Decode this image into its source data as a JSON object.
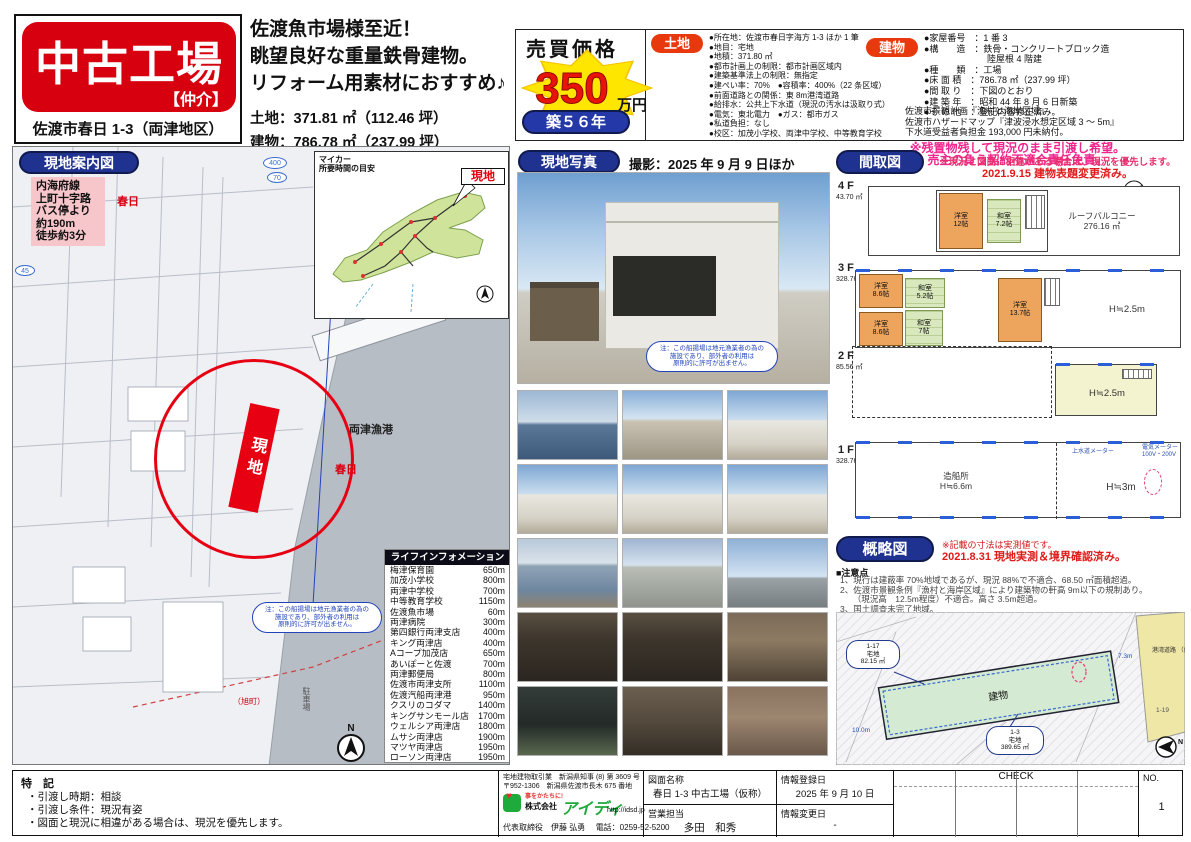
{
  "header": {
    "title": "中古工場",
    "broker": "【仲介】",
    "address": "佐渡市春日 1-3（両津地区）",
    "catch1": "佐渡魚市場様至近！",
    "catch2": "眺望良好な重量鉄骨建物。",
    "catch3": "リフォーム用素材におすすめ♪",
    "land_line": "土地：371.81 ㎡（112.46 坪）",
    "building_line": "建物：786.78 ㎡（237.99 坪）",
    "price_label": "売買価格",
    "price_value": "350",
    "price_unit": "万円",
    "age_badge": "築５６年"
  },
  "land": {
    "label": "土地",
    "items": [
      "●所在地：佐渡市春日字海方 1-3 ほか 1 筆",
      "●地目：宅地",
      "●地積：371.80 ㎡",
      "●都市計画上の制限：都市計画区域内",
      "●建築基準法上の制限：無指定",
      "●建ぺい率：70%　●容積率：400%（22 条区域）",
      "●前面道路との関係：東 8m港湾道路",
      "●給排水：公共上下水道（現況の汚水は汲取り式）",
      "●電気：東北電力　●ガス：都市ガス",
      "●私道負担：なし",
      "●校区：加茂小学校、両津中学校、中等教育学校"
    ]
  },
  "building": {
    "label": "建物",
    "items": [
      "●家屋番号　：1 番 3",
      "●構　　造　：鉄骨・コンクリートブロック造\n　　　　　　　陸屋根 4 階建",
      "●種　　類　：工場",
      "●床 面 積　：786.78 ㎡（237.99 坪）",
      "●間 取 り　：下図のとおり",
      "●建 築 年　：昭和 44 年 8 月 6 日新築",
      "●そ の 他　：登記内容修正済み。"
    ],
    "extra": [
      "佐渡市景観計画『漁村と海岸区域』",
      "佐渡市ハザードマップ『津波浸水想定区域 3 ～ 5m』",
      "下水道受益者負担金 193,000 円未納付。"
    ],
    "warn1": "※残置物残して現況のまま引渡し希望。",
    "warn2": "売主の負う契約不適合責任免責。"
  },
  "map": {
    "header": "現地案内図",
    "bus_note": "内海府線\n上町十字路\nバス停より\n約190m\n徒歩約3分",
    "inset_title": "マイカー\n所要時間の目安",
    "inset_site": "現地",
    "route_400": "400",
    "route_70": "70",
    "route_45": "45",
    "kasuga": "春日",
    "port": "両津漁港",
    "asahi": "（旭町）",
    "parking": "駐車場",
    "site": "現地",
    "boat_note": "注：この船揚場は地元漁業者の為の\n施設であり、部外者の利用は\n原則的に許可が出ません。",
    "compass": "N",
    "lifeline_title": "ライフインフォメーション",
    "lifeline": [
      [
        "梅津保育園",
        "650m"
      ],
      [
        "加茂小学校",
        "800m"
      ],
      [
        "両津中学校",
        "700m"
      ],
      [
        "中等教育学校",
        "1150m"
      ],
      [
        "佐渡魚市場",
        "60m"
      ],
      [
        "両津病院",
        "300m"
      ],
      [
        "第四銀行両津支店",
        "400m"
      ],
      [
        "キング両津店",
        "400m"
      ],
      [
        "Aコープ加茂店",
        "650m"
      ],
      [
        "あいぽーと佐渡",
        "700m"
      ],
      [
        "両津郵便局",
        "800m"
      ],
      [
        "佐渡市両津支所",
        "1100m"
      ],
      [
        "佐渡汽船両津港",
        "950m"
      ],
      [
        "クスリのコダマ",
        "1400m"
      ],
      [
        "キングサンモール店",
        "1700m"
      ],
      [
        "ウェルシア両津店",
        "1800m"
      ],
      [
        "ムサシ両津店",
        "1900m"
      ],
      [
        "マツヤ両津店",
        "1950m"
      ],
      [
        "ローソン両津店",
        "1950m"
      ]
    ]
  },
  "photos": {
    "header": "現地写真",
    "shot": "撮影：2025 年 9 月 9 日ほか",
    "note": "注：この船揚場は地元漁業者の為の\n施設であり、部外者の利用は\n原則的に許可が出ません。",
    "items": [
      {
        "kind": "harbor"
      },
      {
        "kind": "slipway"
      },
      {
        "kind": "exterior"
      },
      {
        "kind": "exterior"
      },
      {
        "kind": "exterior"
      },
      {
        "kind": "exterior"
      },
      {
        "kind": "aerial"
      },
      {
        "kind": "town"
      },
      {
        "kind": "rooftop"
      },
      {
        "kind": "workshop"
      },
      {
        "kind": "workshop"
      },
      {
        "kind": "interior"
      },
      {
        "kind": "bathroom"
      },
      {
        "kind": "corridor"
      },
      {
        "kind": "living"
      }
    ]
  },
  "madori": {
    "header": "間取図",
    "note1": "※現況と図面に相違がある場合は、現況を優先します。",
    "note2": "2021.9.15 建物表題変更済み。",
    "compass": "N",
    "floor4": {
      "name": "4 F",
      "area": "43.70 ㎡",
      "room1": "洋室\n12帖",
      "room2": "和室\n7.2帖",
      "balcony": "ルーフバルコニー\n276.16 ㎡"
    },
    "floor3": {
      "name": "3 F",
      "area": "328.76 ㎡",
      "room1": "洋室\n8.6帖",
      "room2": "和室\n5.2帖",
      "room3": "洋室\n8.6帖",
      "room4": "和室\n7帖",
      "room5": "洋室\n13.7帖",
      "height": "H≒2.5m"
    },
    "floor2": {
      "name": "2 F",
      "area": "85.56 ㎡",
      "height": "H≒2.5m"
    },
    "floor1": {
      "name": "1 F",
      "area": "328.76 ㎡",
      "label": "造船所\nH≒6.6m",
      "height": "H≒3m",
      "meter1": "上水道メーター",
      "meter2": "電気メーター\n100V・200V"
    }
  },
  "sketch": {
    "header": "概略図",
    "note1": "※記載の寸法は実測値です。",
    "note2": "2021.8.31 現地実測＆境界確認済み。",
    "caution_title": "■注意点",
    "cautions": [
      "1、現行は建蔽率 70%地域であるが、現況 88%で不適合、68.50 ㎡面積超過。",
      "2、佐渡市景観条例『漁村と海岸区域』により建築物の軒高 9m以下の規制あり。",
      "　　（現況高　12.5m程度）不適合。高さ 3.5m超過。",
      "3、国土調査未完了地域。"
    ],
    "building_label": "建物",
    "parcel1": "1-17\n宅地\n82.15 ㎡",
    "parcel2": "1-3\n宅地\n389.65 ㎡",
    "road": "港湾道路\n（県管理）\n幅員約8m",
    "road_parcel": "1-19",
    "dim1": "7.3m",
    "dim2": "10.0m",
    "compass": "N"
  },
  "footer": {
    "tokki_title": "特　記",
    "tokki": [
      "・引渡し時期：相談",
      "・引渡し条件：現況有姿",
      "・図面と現況に相違がある場合は、現況を優先します。"
    ],
    "license": "宅地建物取引業　新潟県知事 (8) 第 3609 号",
    "addr": "〒952-1306　新潟県佐渡市長木 675 番地",
    "tagline": "事をかたちに!",
    "corp_prefix": "株式会社",
    "corp_name": "アイディ",
    "url": "http://idsd.jp",
    "rep": "代表取締役　伊藤 弘勇",
    "tel": "電話：0259-52-5200",
    "zumen_label": "図面名称",
    "zumen_value": "春日 1-3 中古工場（仮称）",
    "sales_label": "営業担当",
    "sales_value": "多田　和秀",
    "reg_label": "情報登録日",
    "reg_value": "2025 年 9 月 10 日",
    "chg_label": "情報変更日",
    "chg_value": "-",
    "check": "CHECK",
    "no_label": "NO.",
    "no_value": "1"
  }
}
